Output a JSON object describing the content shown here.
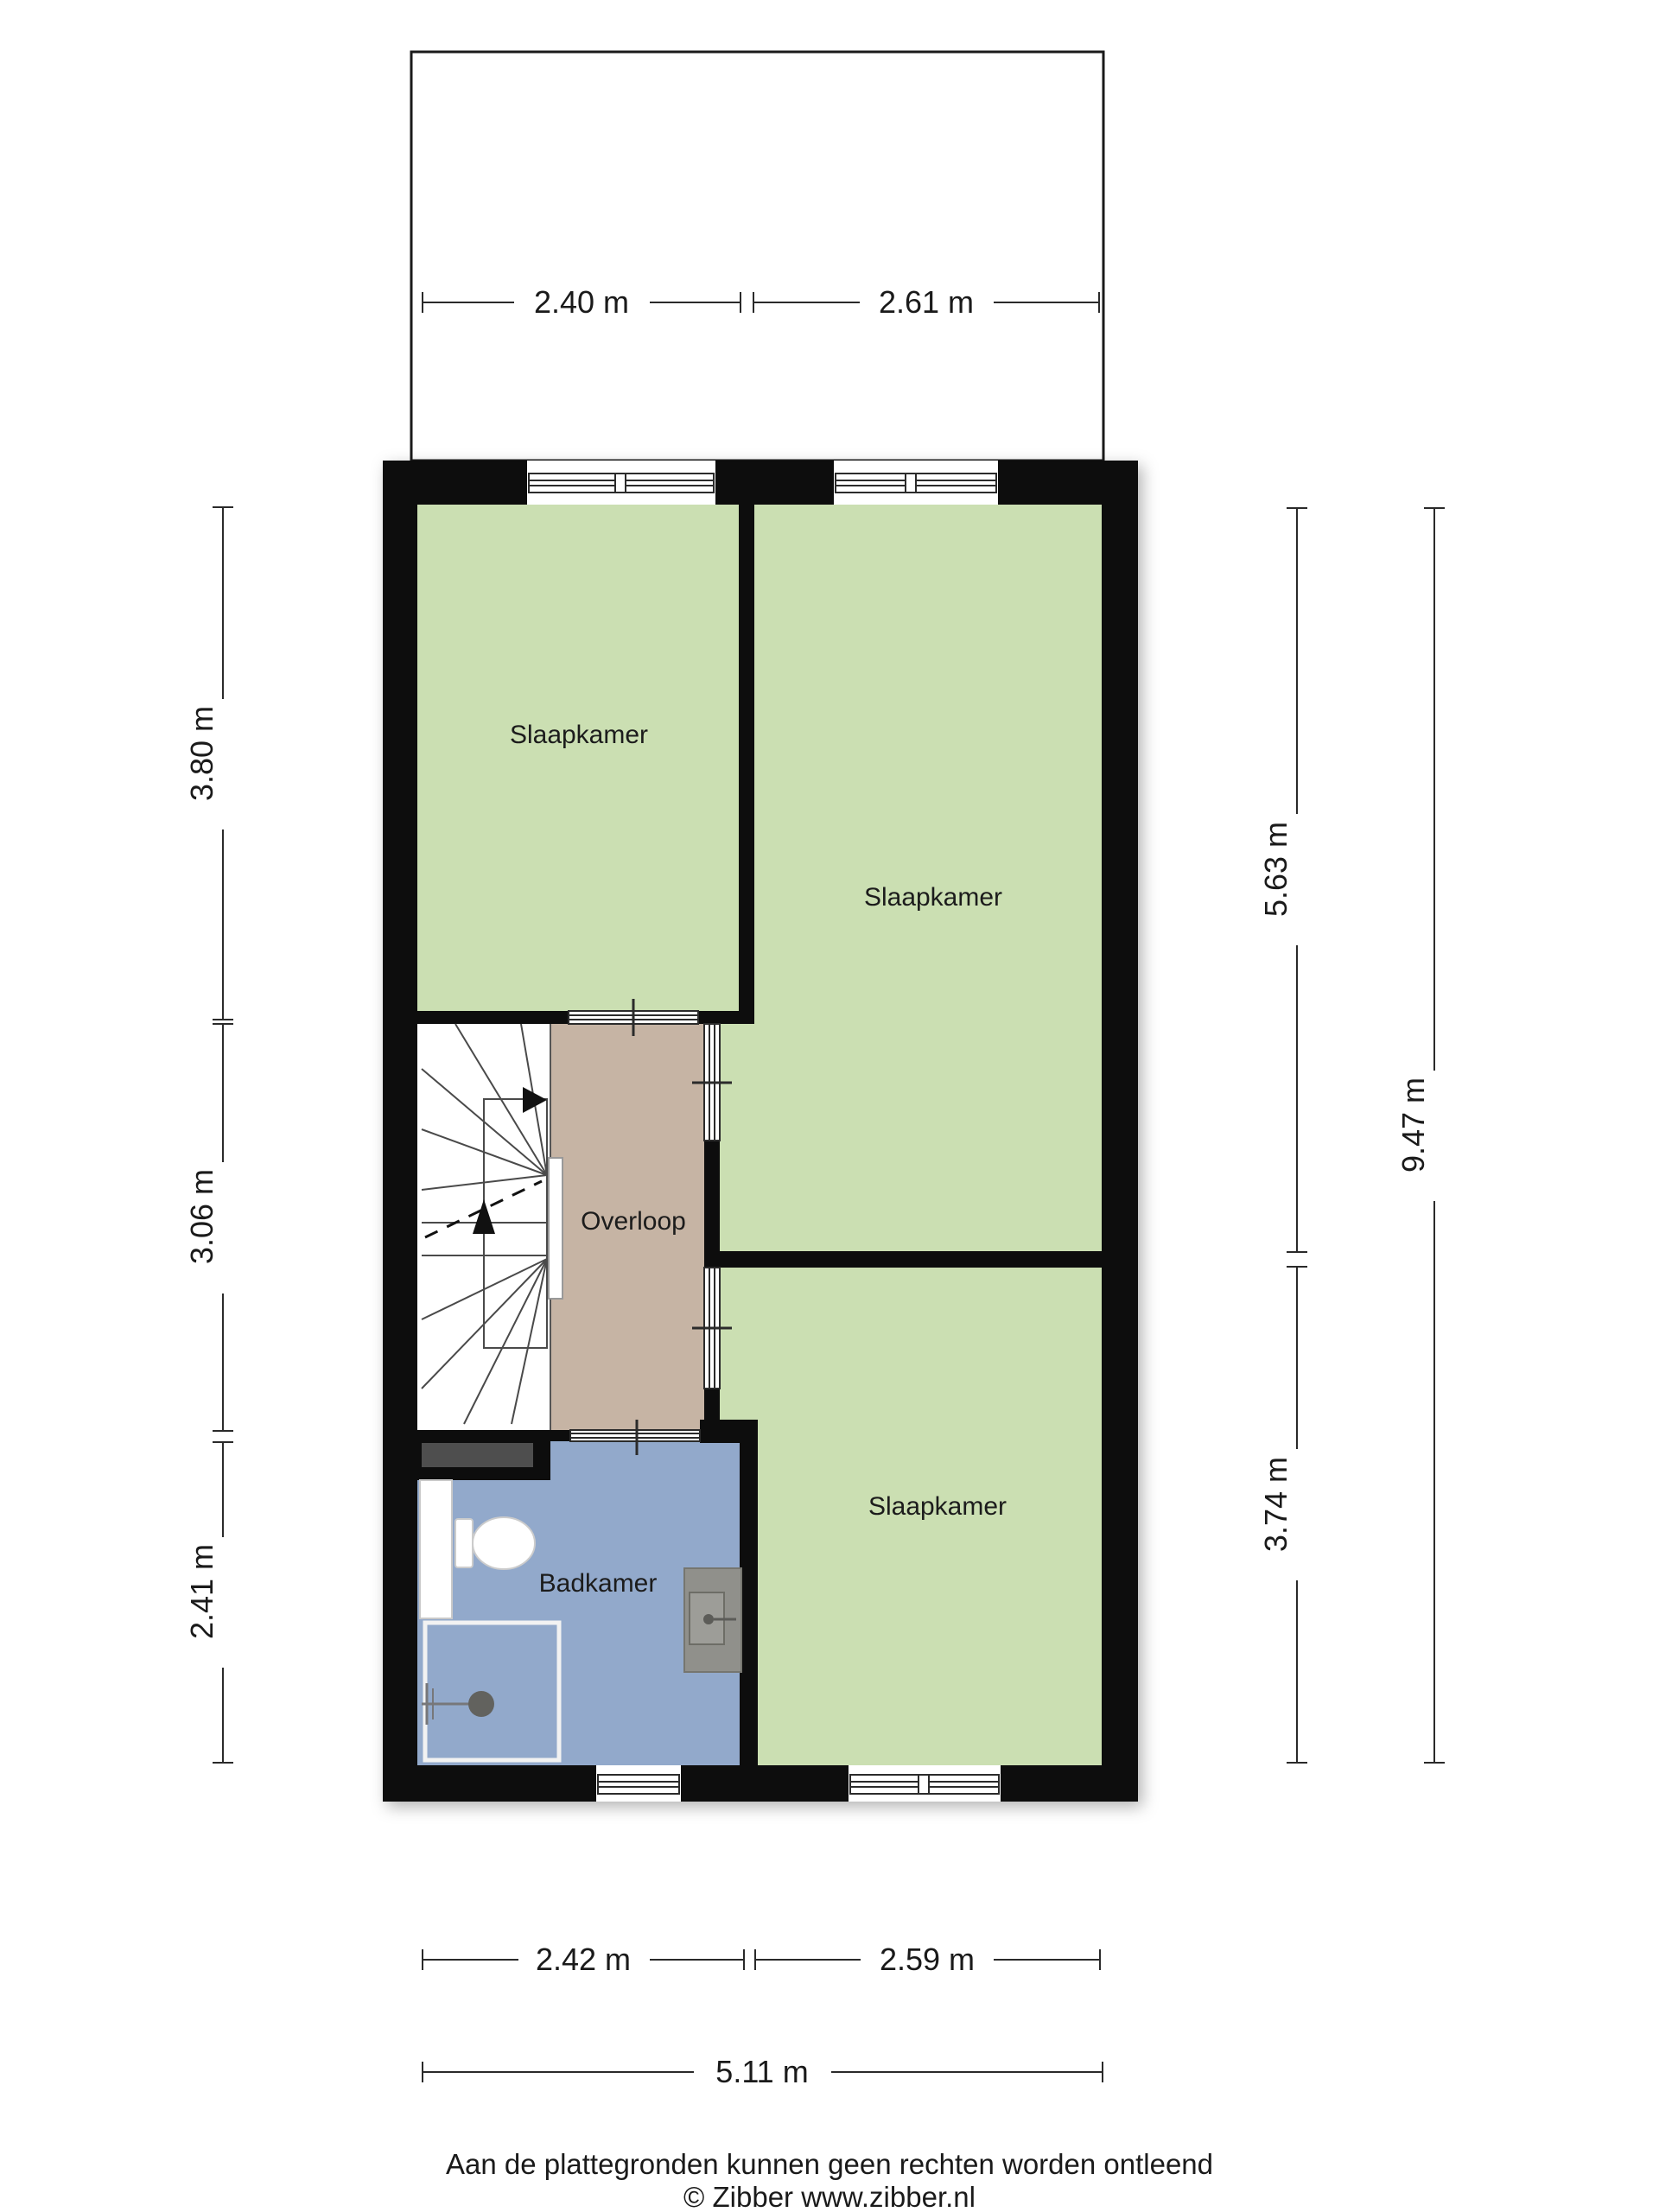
{
  "plan": {
    "rooms": [
      {
        "label": "Slaapkamer"
      },
      {
        "label": "Slaapkamer"
      },
      {
        "label": "Slaapkamer"
      },
      {
        "label": "Overloop"
      },
      {
        "label": "Badkamer"
      }
    ],
    "dimensions": {
      "top": [
        {
          "label": "2.40 m"
        },
        {
          "label": "2.61 m"
        }
      ],
      "left": [
        {
          "label": "3.80 m"
        },
        {
          "label": "3.06 m"
        },
        {
          "label": "2.41 m"
        }
      ],
      "right": [
        {
          "label": "5.63 m"
        },
        {
          "label": "3.74 m"
        }
      ],
      "right_total": {
        "label": "9.47 m"
      },
      "bottom": [
        {
          "label": "2.42 m"
        },
        {
          "label": "2.59 m"
        }
      ],
      "bottom_total": {
        "label": "5.11 m"
      }
    },
    "footer": {
      "line1": "Aan de plattegronden kunnen geen rechten worden ontleend",
      "line2": "© Zibber www.zibber.nl"
    },
    "colors": {
      "wall": "#0d0d0d",
      "room_green": "#cbdfb2",
      "hall_brown": "#c6b4a4",
      "bath_blue": "#92a9cb",
      "shelf_gray": "#4e4e4e",
      "basin_gray": "#90908b",
      "basin_inner": "#9d9d98",
      "fixture_dark": "#62625e"
    }
  }
}
